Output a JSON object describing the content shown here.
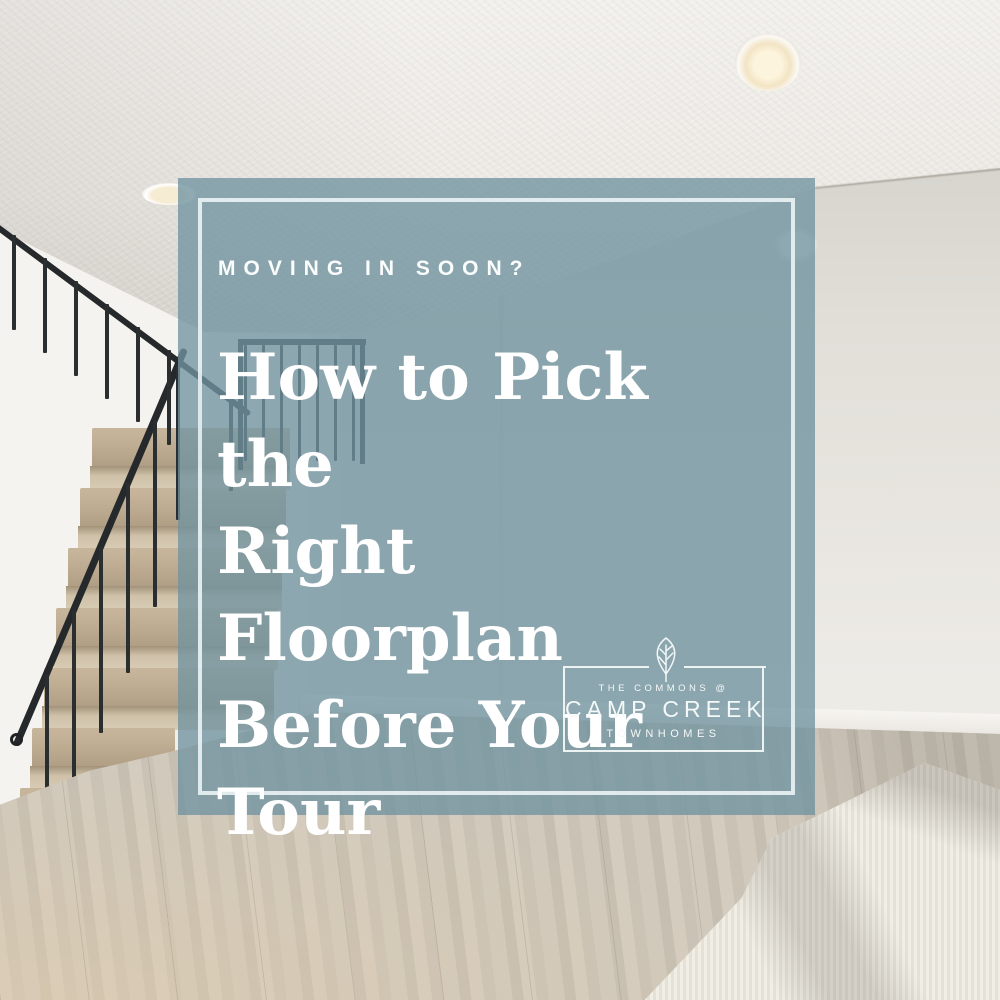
{
  "graphic": {
    "eyebrow": "MOVING IN SOON?",
    "headline": "How to Pick the Right Floorplan Before Your Tour",
    "headline_lines": [
      "How to Pick the",
      "Right Floorplan",
      "Before Your",
      "Tour"
    ]
  },
  "logo": {
    "top_line": "THE COMMONS @",
    "name": "CAMP CREEK",
    "bottom_line": "TOWNHOMES",
    "icon": "leaf-tree-icon"
  },
  "colors": {
    "overlay_fill": "#7194A0",
    "overlay_opacity": "0.78",
    "inner_border": "#E9F1F3",
    "text": "#FFFFFF",
    "logo_border": "#F2F7F7",
    "stair_carpet": "#BCAB90",
    "floor_wood": "#CDC5B8",
    "wall": "#E3E0DA",
    "ceiling": "#EFEDE9"
  }
}
